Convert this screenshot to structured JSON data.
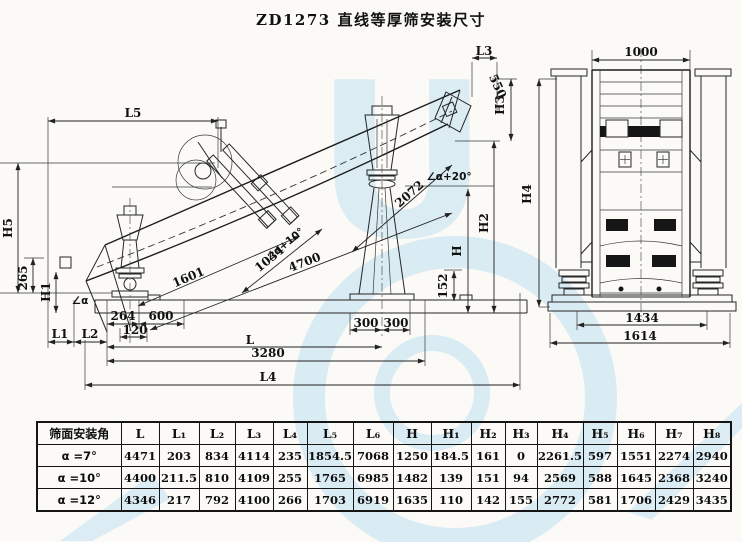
{
  "page": {
    "title": "ZD1273 直线等厚筛安装尺寸"
  },
  "colors": {
    "paper": "#fbfaf7",
    "ink": "#1f1f1f",
    "watermark": "#a9d6ef"
  },
  "watermark": {
    "letter": "U"
  },
  "labels": {
    "side": {
      "L5": "L5",
      "H5": "H5",
      "d265": "265",
      "H1": "H1",
      "alpha": "∠α",
      "L1": "L1",
      "L2": "L2",
      "d264": "264",
      "d120": "120",
      "d600": "600",
      "d1601": "1601",
      "d1034": "1034",
      "a10": "∠α+10°",
      "d4700": "4700",
      "d2072": "2072",
      "a20": "∠α+20°",
      "d300a": "300",
      "d300b": "300",
      "L": "L",
      "d3280": "3280",
      "L4": "L4",
      "d152": "152",
      "H": "H",
      "H2": "H2",
      "H3": "H3",
      "L3": "L3",
      "d550": "550"
    },
    "front": {
      "d1000": "1000",
      "H4": "H4",
      "d1434": "1434",
      "d1614": "1614"
    }
  },
  "table": {
    "header": [
      "筛面安装角",
      "L",
      "L₁",
      "L₂",
      "L₃",
      "L₄",
      "L₅",
      "L₆",
      "H",
      "H₁",
      "H₂",
      "H₃",
      "H₄",
      "H₅",
      "H₆",
      "H₇",
      "H₈"
    ],
    "rows": [
      {
        "angle": "α =7°",
        "values": [
          "4471",
          "203",
          "834",
          "4114",
          "235",
          "1854.5",
          "7068",
          "1250",
          "184.5",
          "161",
          "0",
          "2261.5",
          "597",
          "1551",
          "2274",
          "2940"
        ]
      },
      {
        "angle": "α =10°",
        "values": [
          "4400",
          "211.5",
          "810",
          "4109",
          "255",
          "1765",
          "6985",
          "1482",
          "139",
          "151",
          "94",
          "2569",
          "588",
          "1645",
          "2368",
          "3240"
        ]
      },
      {
        "angle": "α =12°",
        "values": [
          "4346",
          "217",
          "792",
          "4100",
          "266",
          "1703",
          "6919",
          "1635",
          "110",
          "142",
          "155",
          "2772",
          "581",
          "1706",
          "2429",
          "3435"
        ]
      }
    ]
  }
}
